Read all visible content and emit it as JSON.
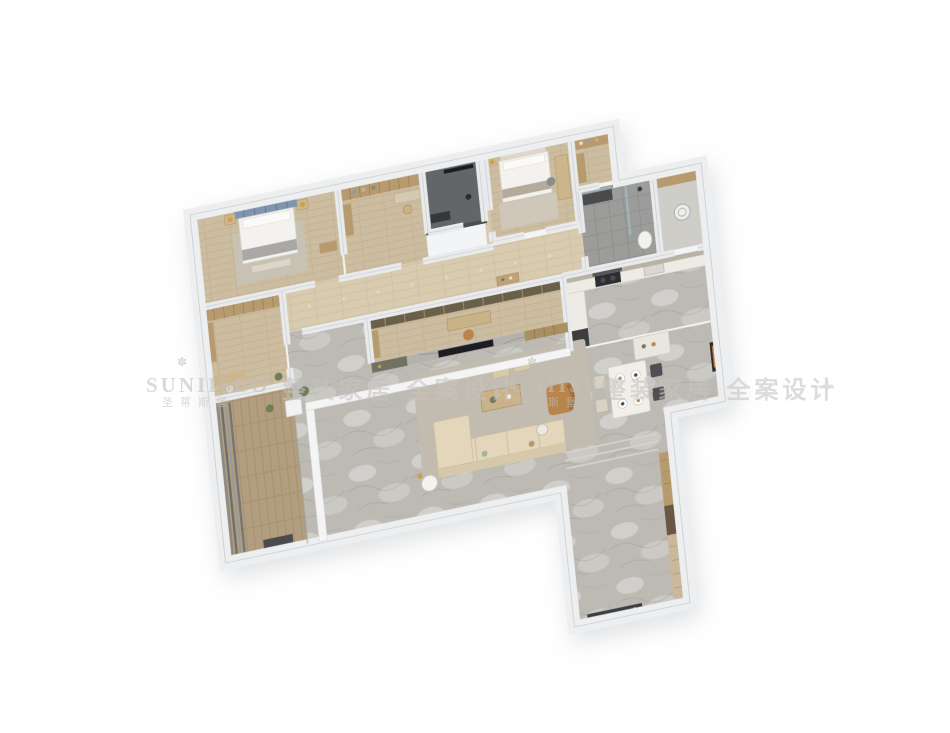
{
  "watermark": {
    "brand": "SUNIISBO",
    "brand_cn": "圣蒂斯堡",
    "slogan": "整装家居 全案设计",
    "mark": "✽",
    "separator": "+",
    "color": "#c2c0bc"
  },
  "palette": {
    "background": "#ffffff",
    "outer_wall": "#eceef0",
    "inner_wall": "#e8eaec",
    "wood_floor": "#cdbda0",
    "corridor_wood": "#d8cbb0",
    "marble_floor": "#bdbab4",
    "balcony_wood": "#b29e7e",
    "bathroom_tile": "#9c9d9b",
    "dark_bathroom": "#646669",
    "sofa_beige": "#e3d6ba",
    "leather_tan": "#b9854e",
    "headboard_blue": "#7e95ad",
    "cabinet_tan": "#b79b6e",
    "shelf_bronze": "#6b5f4a",
    "counter_white": "#edebe3",
    "appliance_dark": "#3c3e40",
    "tv_black": "#1d1f21"
  }
}
